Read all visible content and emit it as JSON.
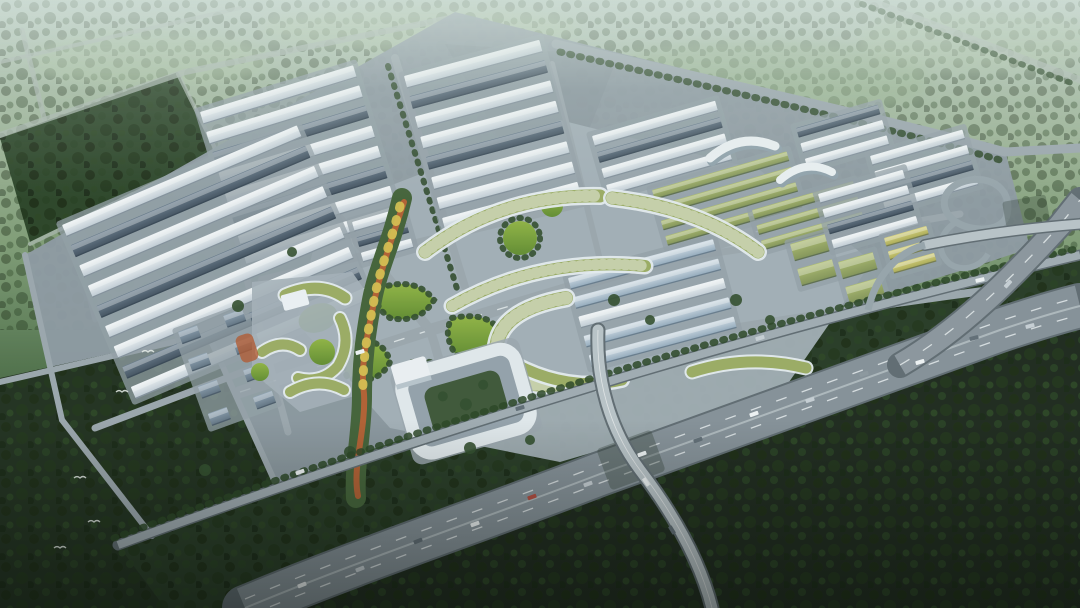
{
  "scene": {
    "type": "aerial-architectural-rendering",
    "description": "Hazy bird's-eye 3D rendering of a large industrial park masterplan: rows of white and slate-roofed warehouses, long green-roofed factory halls, arc-shaped green-roof buildings around a landscaped central crossroads with lawns, a winding orange ribbon park, a villa cluster, a white courtyard headquarters building, a curved multi-lane expressway with overpass and loop-ramp interchange, all framed by dark forest belts and misty green fields.",
    "lighting": "overcast haze, cool blue-green cast"
  },
  "palette": {
    "haze_top": "#cfe0da",
    "field_green": "#8fae8a",
    "forest_top": "#2e4a29",
    "forest_mid": "#263f22",
    "forest_dark": "#19261710",
    "forest_sw": "#1b2a19",
    "forest_south": "#182317",
    "greenbelt": "#223520",
    "ground_gray": "#8d98a1",
    "plaza_gray": "#a4afb8",
    "road_light": "#9aa5ad",
    "highway_asphalt": "#848f97",
    "highway_casing": "#5d686f",
    "roof_white": "#eef3f7",
    "roof_dark": "#4e5f70",
    "roof_green": "#9aab60",
    "roof_blue": "#b9cad9",
    "roof_yellow": "#c9c56b",
    "villa_roof": "#70818f",
    "lawn_green": "#7fa838",
    "tree_green": "#24401f",
    "ribbon_orange": "#b85c2e",
    "accent_yellow": "#d9c24e",
    "marking_white": "#e8ecef"
  },
  "districts": [
    {
      "name": "warehouse-district-north-a",
      "x": 200,
      "y": 112,
      "rot": -17,
      "len": 160,
      "rowH": 13,
      "gap": 8,
      "pattern": [
        "white",
        "white",
        "dark",
        "white",
        "white",
        "dark",
        "white",
        "white"
      ]
    },
    {
      "name": "warehouse-district-north-b",
      "x": 404,
      "y": 76,
      "rot": -15,
      "len": 140,
      "rowH": 13,
      "gap": 8,
      "pattern": [
        "white",
        "dark",
        "white",
        "white",
        "dark",
        "white",
        "white",
        "white"
      ]
    },
    {
      "name": "warehouse-district-west",
      "x": 62,
      "y": 225,
      "rot": -23,
      "len": 255,
      "rowH": 13,
      "gap": 9,
      "pattern": [
        "white",
        "dark",
        "white",
        "white",
        "dark",
        "white",
        "white",
        "dark",
        "white"
      ]
    },
    {
      "name": "warehouse-rows-ne-white",
      "x": 592,
      "y": 136,
      "rot": -16,
      "len": 128,
      "rowH": 11,
      "gap": 6,
      "pattern": [
        "white",
        "dark",
        "white",
        "white"
      ]
    },
    {
      "name": "green-roof-rows-a",
      "x": 652,
      "y": 190,
      "rot": -16,
      "len": 140,
      "rowH": 10,
      "gap": 6,
      "pattern": [
        "green",
        "green",
        "green",
        "green"
      ]
    },
    {
      "name": "green-roof-rows-b",
      "x": 752,
      "y": 210,
      "rot": -16,
      "len": 105,
      "rowH": 10,
      "gap": 6,
      "pattern": [
        "green",
        "green",
        "green"
      ]
    },
    {
      "name": "warehouse-block-ne-east",
      "x": 796,
      "y": 128,
      "rot": -16,
      "len": 85,
      "rowH": 10,
      "gap": 6,
      "pattern": [
        "dark",
        "white",
        "white"
      ]
    },
    {
      "name": "warehouse-block-far-east",
      "x": 870,
      "y": 156,
      "rot": -16,
      "len": 96,
      "rowH": 10,
      "gap": 6,
      "pattern": [
        "white",
        "white",
        "dark",
        "white"
      ]
    },
    {
      "name": "warehouse-block-east-2",
      "x": 818,
      "y": 194,
      "rot": -16,
      "len": 88,
      "rowH": 10,
      "gap": 6,
      "pattern": [
        "white",
        "white",
        "dark",
        "white"
      ]
    },
    {
      "name": "green-square-blocks-a",
      "x": 790,
      "y": 244,
      "rot": -16,
      "len": 36,
      "rowH": 18,
      "gap": 8,
      "pattern": [
        "green",
        "green"
      ]
    },
    {
      "name": "green-square-blocks-b",
      "x": 838,
      "y": 262,
      "rot": -16,
      "len": 36,
      "rowH": 18,
      "gap": 8,
      "pattern": [
        "green",
        "green"
      ]
    },
    {
      "name": "yellow-roof-block",
      "x": 884,
      "y": 238,
      "rot": -16,
      "len": 44,
      "rowH": 9,
      "gap": 5,
      "pattern": [
        "yellow",
        "yellow",
        "yellow"
      ]
    },
    {
      "name": "warehouse-block-center-striped",
      "x": 568,
      "y": 278,
      "rot": -15,
      "len": 150,
      "rowH": 12,
      "gap": 8,
      "pattern": [
        "blue",
        "blue",
        "white",
        "blue",
        "blue"
      ]
    },
    {
      "name": "small-block-plaza-nw",
      "x": 352,
      "y": 222,
      "rot": -16,
      "len": 52,
      "rowH": 10,
      "gap": 6,
      "pattern": [
        "white",
        "dark",
        "white"
      ]
    },
    {
      "name": "villa-cluster",
      "x": 178,
      "y": 332,
      "rot": -20,
      "cols": 2,
      "rowsN": 4,
      "w": 20,
      "rowH": 13,
      "gap": 16,
      "colGap": 28,
      "pattern": [
        "villa"
      ]
    }
  ],
  "vehicles": {
    "colors": [
      "#f2f5f7",
      "#c8cfd5",
      "#5e6a74",
      "#b2463a",
      "#8b969e"
    ],
    "list": [
      [
        302,
        585,
        -21,
        0
      ],
      [
        360,
        569,
        -21,
        1
      ],
      [
        418,
        541,
        -21,
        2
      ],
      [
        475,
        524,
        -20,
        0
      ],
      [
        532,
        497,
        -20,
        3
      ],
      [
        588,
        484,
        -20,
        1
      ],
      [
        642,
        454,
        -19,
        0
      ],
      [
        698,
        440,
        -19,
        2
      ],
      [
        754,
        414,
        -19,
        0
      ],
      [
        810,
        400,
        -18,
        1
      ],
      [
        864,
        374,
        -17,
        4
      ],
      [
        920,
        362,
        -16,
        0
      ],
      [
        974,
        338,
        -15,
        2
      ],
      [
        1030,
        326,
        -14,
        1
      ],
      [
        300,
        472,
        -20,
        0
      ],
      [
        520,
        408,
        -17,
        2
      ],
      [
        760,
        338,
        -16,
        1
      ],
      [
        980,
        280,
        -13,
        0
      ],
      [
        646,
        482,
        56,
        0
      ],
      [
        672,
        530,
        58,
        2
      ],
      [
        1008,
        284,
        -48,
        1
      ],
      [
        360,
        352,
        -17,
        0
      ]
    ]
  },
  "birds": [
    [
      122,
      392
    ],
    [
      80,
      478
    ],
    [
      94,
      522
    ],
    [
      60,
      548
    ],
    [
      148,
      352
    ]
  ],
  "features": [
    "warehouse districts",
    "green-roof factory halls",
    "arc-shaped green-roof buildings",
    "central lawn crossroads",
    "orange ribbon park",
    "villa cluster",
    "courtyard headquarters building",
    "expressway",
    "overpass",
    "loop-ramp interchange",
    "forest belts",
    "misty fields",
    "crescent exhibition halls"
  ]
}
